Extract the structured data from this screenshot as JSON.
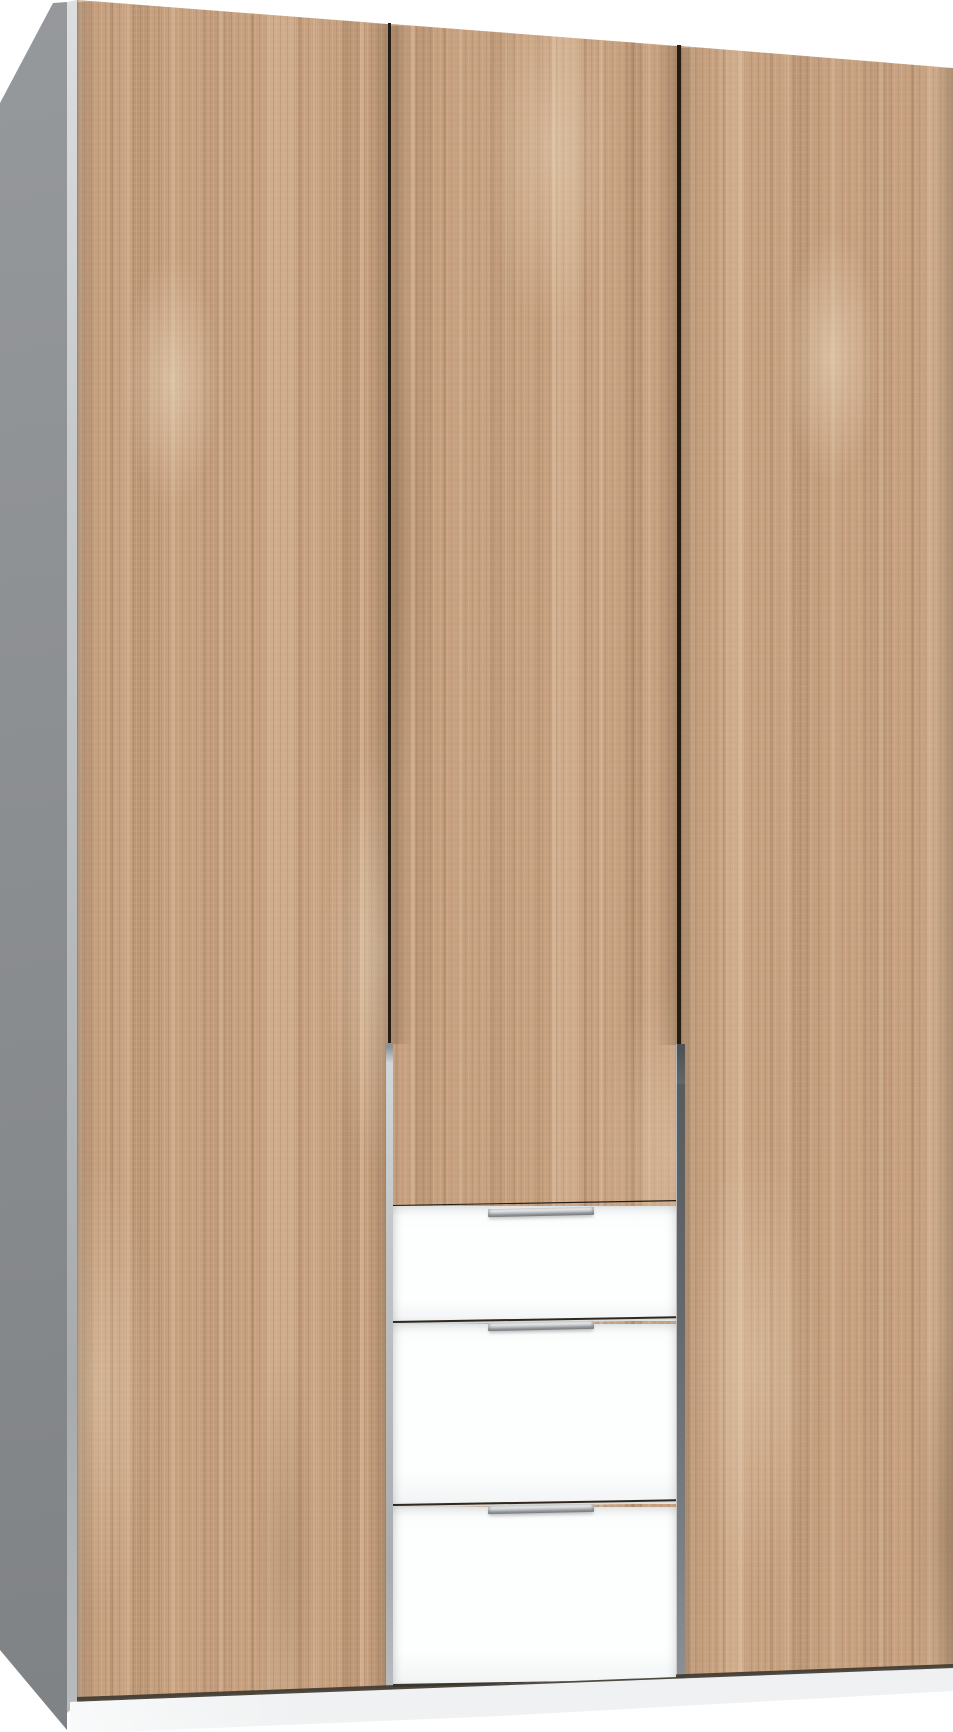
{
  "meta": {
    "type": "product-photo",
    "subject": "Three-door wardrobe in light oak finish with three white drawers in the centre section",
    "text_content": "none"
  },
  "wardrobe": {
    "side_panel": {
      "label": "left side panel",
      "finish": "grey"
    },
    "doors": [
      {
        "label": "left wardrobe door",
        "finish": "light oak wood grain"
      },
      {
        "label": "middle wardrobe door",
        "finish": "light oak wood grain"
      },
      {
        "label": "right wardrobe door",
        "finish": "light oak wood grain"
      }
    ],
    "drawers": [
      {
        "label": "top drawer",
        "finish": "white"
      },
      {
        "label": "middle drawer",
        "finish": "white"
      },
      {
        "label": "bottom drawer",
        "finish": "white"
      }
    ],
    "handles": {
      "label": "slim metal bar handle",
      "finish": "silver",
      "count": 3
    },
    "plinth": {
      "label": "plinth",
      "finish": "light grey"
    }
  },
  "colors": {
    "background": "#ffffff",
    "wood_base": "#c6a07f",
    "wood_light": "#e4cba8",
    "wood_dark": "#9b7757",
    "gap_line": "#221c15",
    "side_panel_top": "#96999c",
    "side_panel_bottom": "#7e8184",
    "edge_silver_light": "#dcdedf",
    "edge_silver_dark": "#a8abad",
    "carcass_strip_left": "#c3c6c8",
    "carcass_strip_right": "#63676a",
    "drawer_white": "#fdfefe",
    "drawer_shadow": "#e6e8e9",
    "handle_light": "#f1f2f3",
    "handle_mid": "#c0c3c5",
    "handle_dark": "#7c7f81",
    "plinth_top": "#c7cacc",
    "plinth_bottom": "#f0f2f3"
  }
}
